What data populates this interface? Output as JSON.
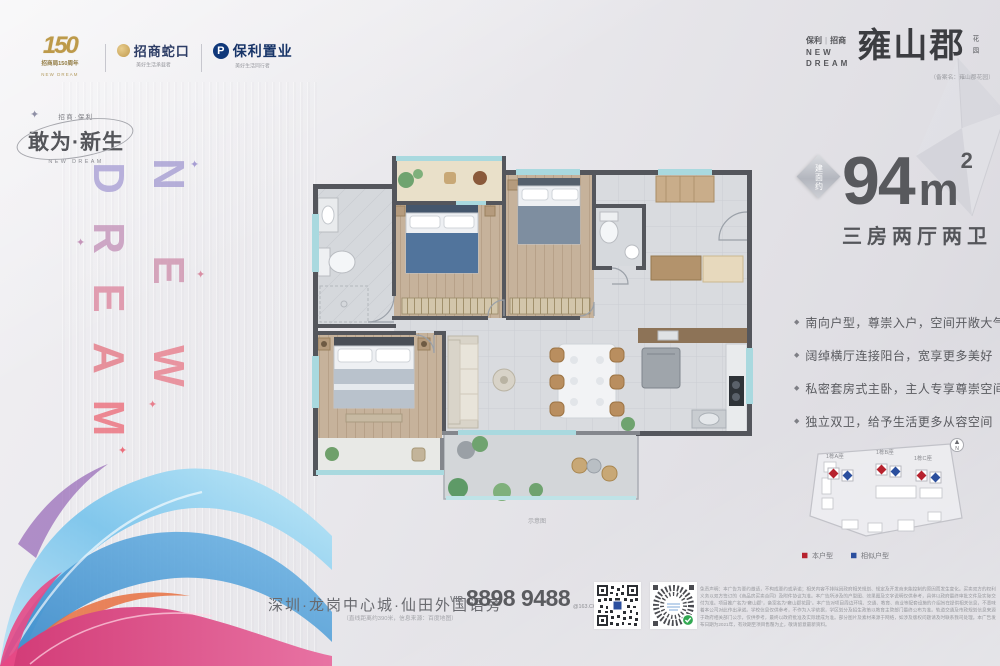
{
  "logos": {
    "anniversary": {
      "number": "150",
      "caption": "招商局150周年",
      "sub": "NEW DREAM"
    },
    "cmsk": {
      "name": "招商蛇口",
      "caption": "美好生活承载者"
    },
    "poly": {
      "name": "保利置业",
      "initial": "P",
      "caption": "美好生活同行者"
    }
  },
  "left_brand": {
    "small_top": "招商·保利",
    "slogan": "敢为·新生",
    "slogan_en": "NEW DREAM",
    "word_new": [
      "N",
      "E",
      "W"
    ],
    "word_dream": [
      "D",
      "R",
      "E",
      "A",
      "M"
    ]
  },
  "decor": {
    "sparkle": "✦",
    "bullet": "◆"
  },
  "project": {
    "developer_left": "保利",
    "developer_right": "招商",
    "dream_line1": "NEW",
    "dream_line2": "DREAM",
    "name": "雍山郡",
    "suffix_chars": [
      "花",
      "园"
    ],
    "filing": "（备案名：雍山郡花园）"
  },
  "area": {
    "badge": "建面约",
    "value": "94",
    "unit": "m",
    "sup": "2",
    "layout": "三房两厅两卫"
  },
  "selling_points": [
    "南向户型，尊崇入户，空间开敞大气",
    "阔绰横厅连接阳台，宽享更多美好",
    "私密套房式主卧，主人专享尊崇空间",
    "独立双卫，给予生活更多从容空间"
  ],
  "floorplan": {
    "caption": "示意图"
  },
  "sitemap": {
    "towers": [
      "1栋A座",
      "1栋B座",
      "1栋C座"
    ],
    "north": "N",
    "legend": [
      {
        "label": "本户型",
        "color": "#b7222e"
      },
      {
        "label": "相似户型",
        "color": "#2b4f9e"
      }
    ]
  },
  "footer": {
    "address": "深圳·龙岗中心城·仙田外国语旁",
    "address_note": "（直线距离约390米，信息来源：百度地图）",
    "vip": "VIP",
    "phone": "8898 9488",
    "phone_suffix": "@163.COM",
    "disclaimer": "免责声明：本广告为要约邀请，不构成要约或承诺；相关内容不排除因政府相关规划、规定及开发商未能控制的原因而发生变化。买卖双方的权利义务以双方签订的《商品房买卖合同》及附件协议为准。本广告所涉及的户型图、效果图及文字说明仅供参考，具体以政府最终审批文件及实际交付为准。项目推广名为“雍山郡”，备案名为“雍山郡花园”。本广告对项目周边环境、交通、教育、商业等配套设施的介绍旨在提供相关信息，不意味着本公司对此作出承诺。学校信息仅供参考，不作为入学依据，学区划分及招生政策以教育主管部门最终公布为准。轨道交通及市政规划信息来源于政府相关部门公示，仅供参考，最终以政府批准及实际建成为准。部分图片及素材来源于网络，如涉及版权问题请及时联系我司处理。本广告发布日期为2021年，有效期至项目售罄为止，敬请留意最新资料。"
  }
}
